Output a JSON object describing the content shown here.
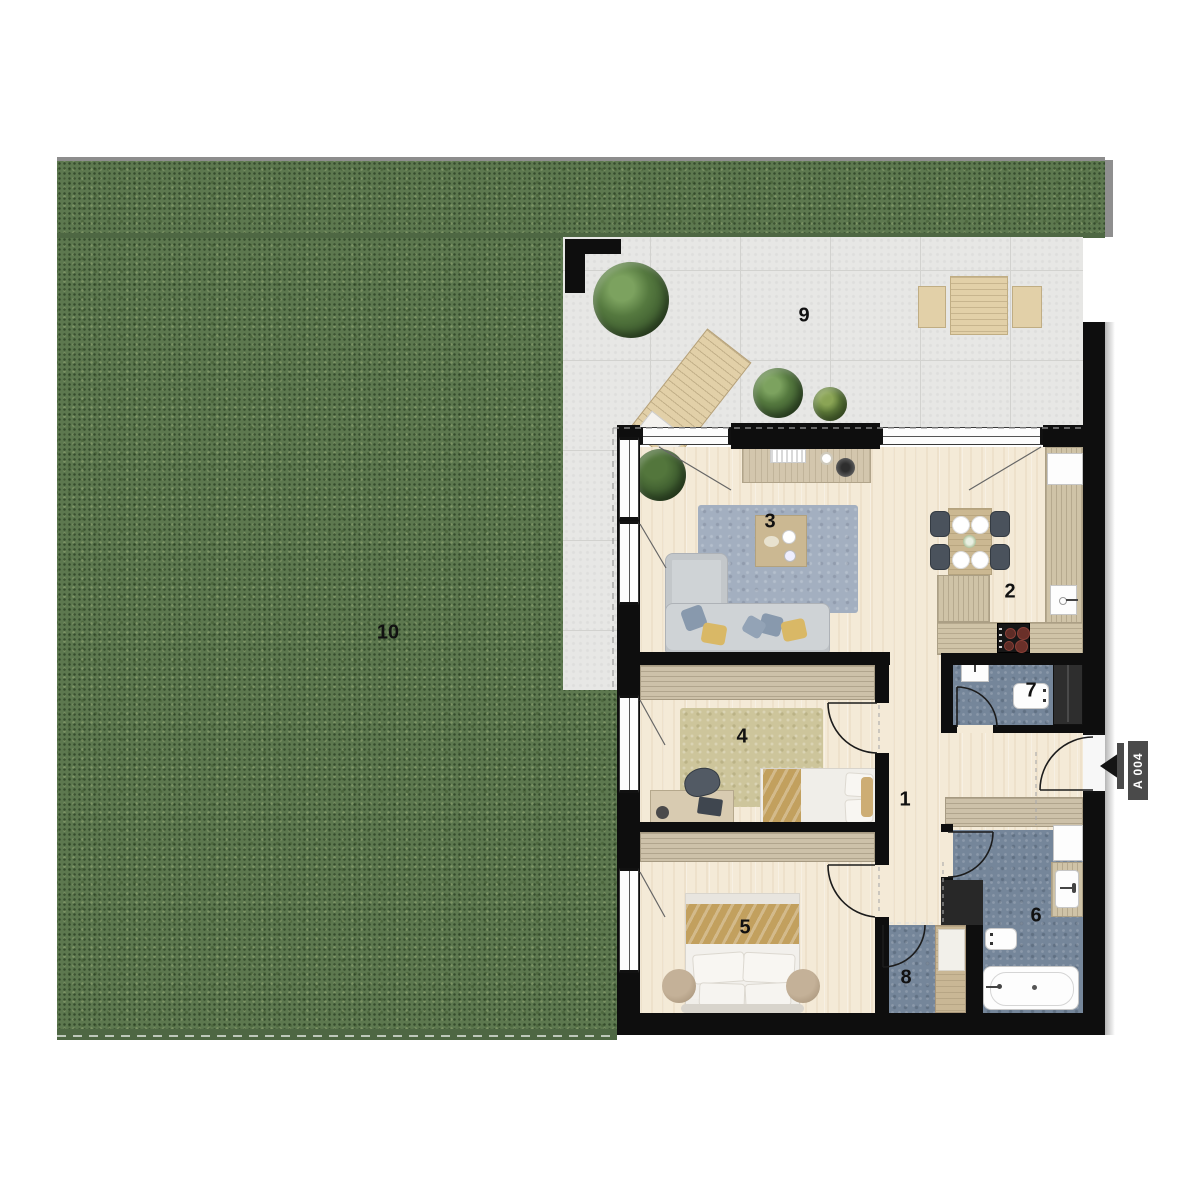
{
  "title": "apartment-floor-plan",
  "rooms": {
    "hallway": {
      "number": "1"
    },
    "kitchen": {
      "number": "2"
    },
    "living_room": {
      "number": "3"
    },
    "bedroom_1": {
      "number": "4"
    },
    "bedroom_2": {
      "number": "5"
    },
    "bathroom": {
      "number": "6"
    },
    "wc": {
      "number": "7"
    },
    "storage": {
      "number": "8"
    },
    "terrace": {
      "number": "9"
    },
    "garden": {
      "number": "10"
    }
  },
  "entrance": {
    "unit_label": "A 004"
  },
  "furniture": {
    "terrace": [
      "tree",
      "sun-lounger",
      "potted-plant",
      "potted-plant",
      "outdoor-table",
      "bench",
      "bench"
    ],
    "living_room": [
      "corner-sofa",
      "rug",
      "coffee-table",
      "sideboard",
      "plant"
    ],
    "kitchen": [
      "dining-table",
      "chairs",
      "plates",
      "kitchen-counter",
      "sink",
      "cooktop",
      "appliance"
    ],
    "bedroom_1": [
      "bed",
      "rug",
      "desk",
      "desk-chair",
      "wardrobe"
    ],
    "bedroom_2": [
      "bed",
      "nightstand",
      "nightstand",
      "wardrobe"
    ],
    "bathroom": [
      "bathtub",
      "washbasin",
      "toilet",
      "shower-cabinet"
    ],
    "wc": [
      "washbasin",
      "toilet",
      "built-in-closet"
    ],
    "storage": [
      "cabinet"
    ],
    "hallway": [
      "built-in-wardrobe"
    ]
  },
  "colors": {
    "grass": "#5d784f",
    "grass_dark": "#4e6743",
    "grass_edge": "#8d8d8d",
    "tile": "#e7e7e5",
    "tile_line": "#d2d2cf",
    "wall": "#0e0e0e",
    "wood_floor": "#f4ead7",
    "cabinet_wood": "#cdc1a9",
    "counter_wood": "#cfc3a7",
    "rug_blue": "#a3afc0",
    "rug_olive": "#cdc59b",
    "bath_floor": "#75869a",
    "sofa": "#cfd3d6",
    "blanket_tan": "#c2a05e",
    "label": "#111111",
    "flag_gray": "#4a4a4a",
    "terrace_wood": "#e2d0a8"
  }
}
